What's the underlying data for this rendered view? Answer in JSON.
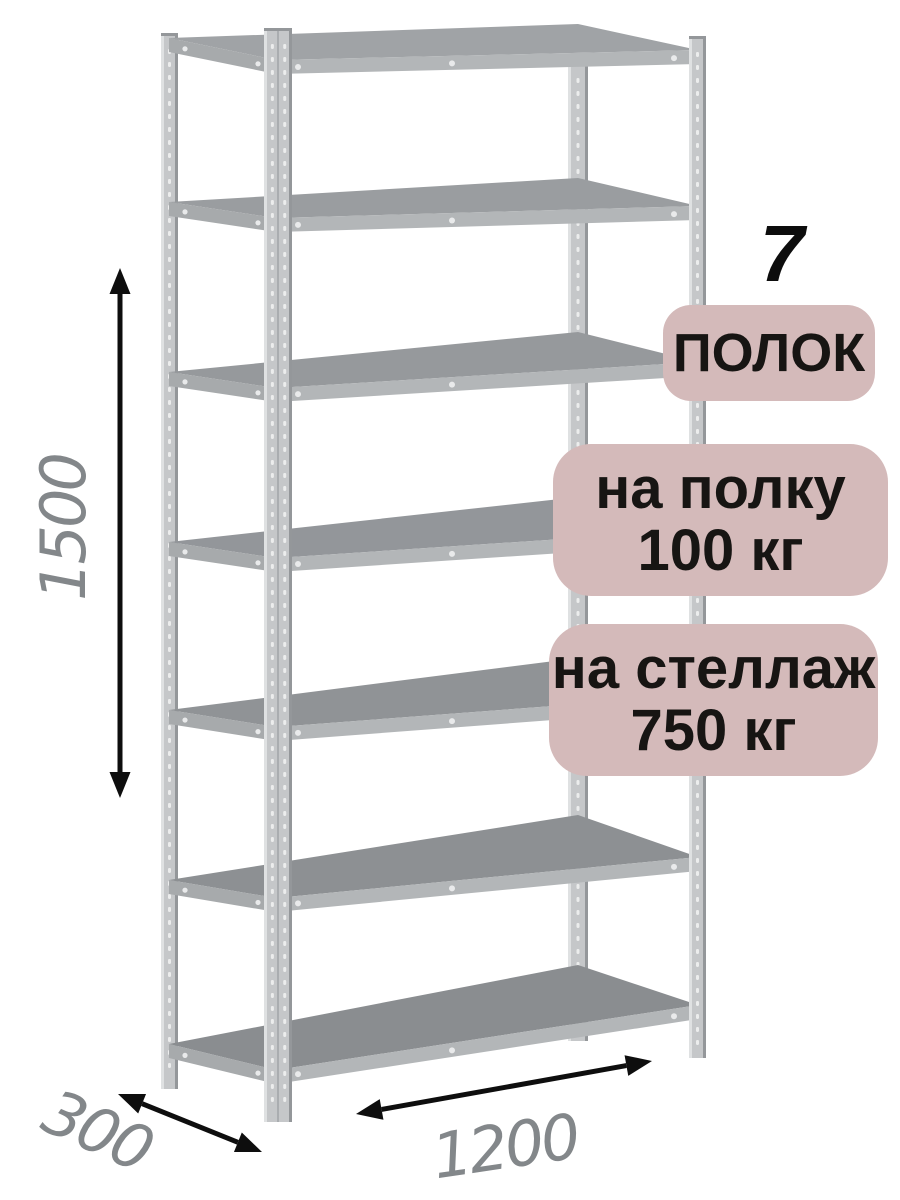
{
  "image": {
    "type": "product-dimension-diagram",
    "subject": "metal boltless shelving rack, 7 shelves, front-left perspective view"
  },
  "labels": {
    "shelf_count_number": "7",
    "shelf_count_unit": "ПОЛОК",
    "per_shelf_line1": "на полку",
    "per_shelf_line2": "100 кг",
    "per_rack_line1": "на стеллаж",
    "per_rack_line2": "750 кг"
  },
  "dimensions": {
    "height_mm": "1500",
    "depth_mm": "300",
    "width_mm": "1200"
  },
  "rack": {
    "shelves": 7,
    "posts": 4
  },
  "colors": {
    "background": "#ffffff",
    "badge_bg": "#d4baba",
    "badge_text": "#171513",
    "count_text": "#0d0d0d",
    "dimension_text": "#83878a",
    "arrow": "#0e0e0e",
    "post_fill": "#c5c7c9",
    "post_highlight": "#dfe1e2",
    "post_shadow": "#94979a",
    "post_hole": "#eceded",
    "shelf_front": "#b3b6b8",
    "shelf_side": "#a7aaac",
    "shelf_screw": "#e9eaeb",
    "shelf_tops": [
      "#a0a3a6",
      "#9a9da0",
      "#96999c",
      "#93969a",
      "#909396",
      "#8d9093",
      "#8a8d90"
    ]
  }
}
